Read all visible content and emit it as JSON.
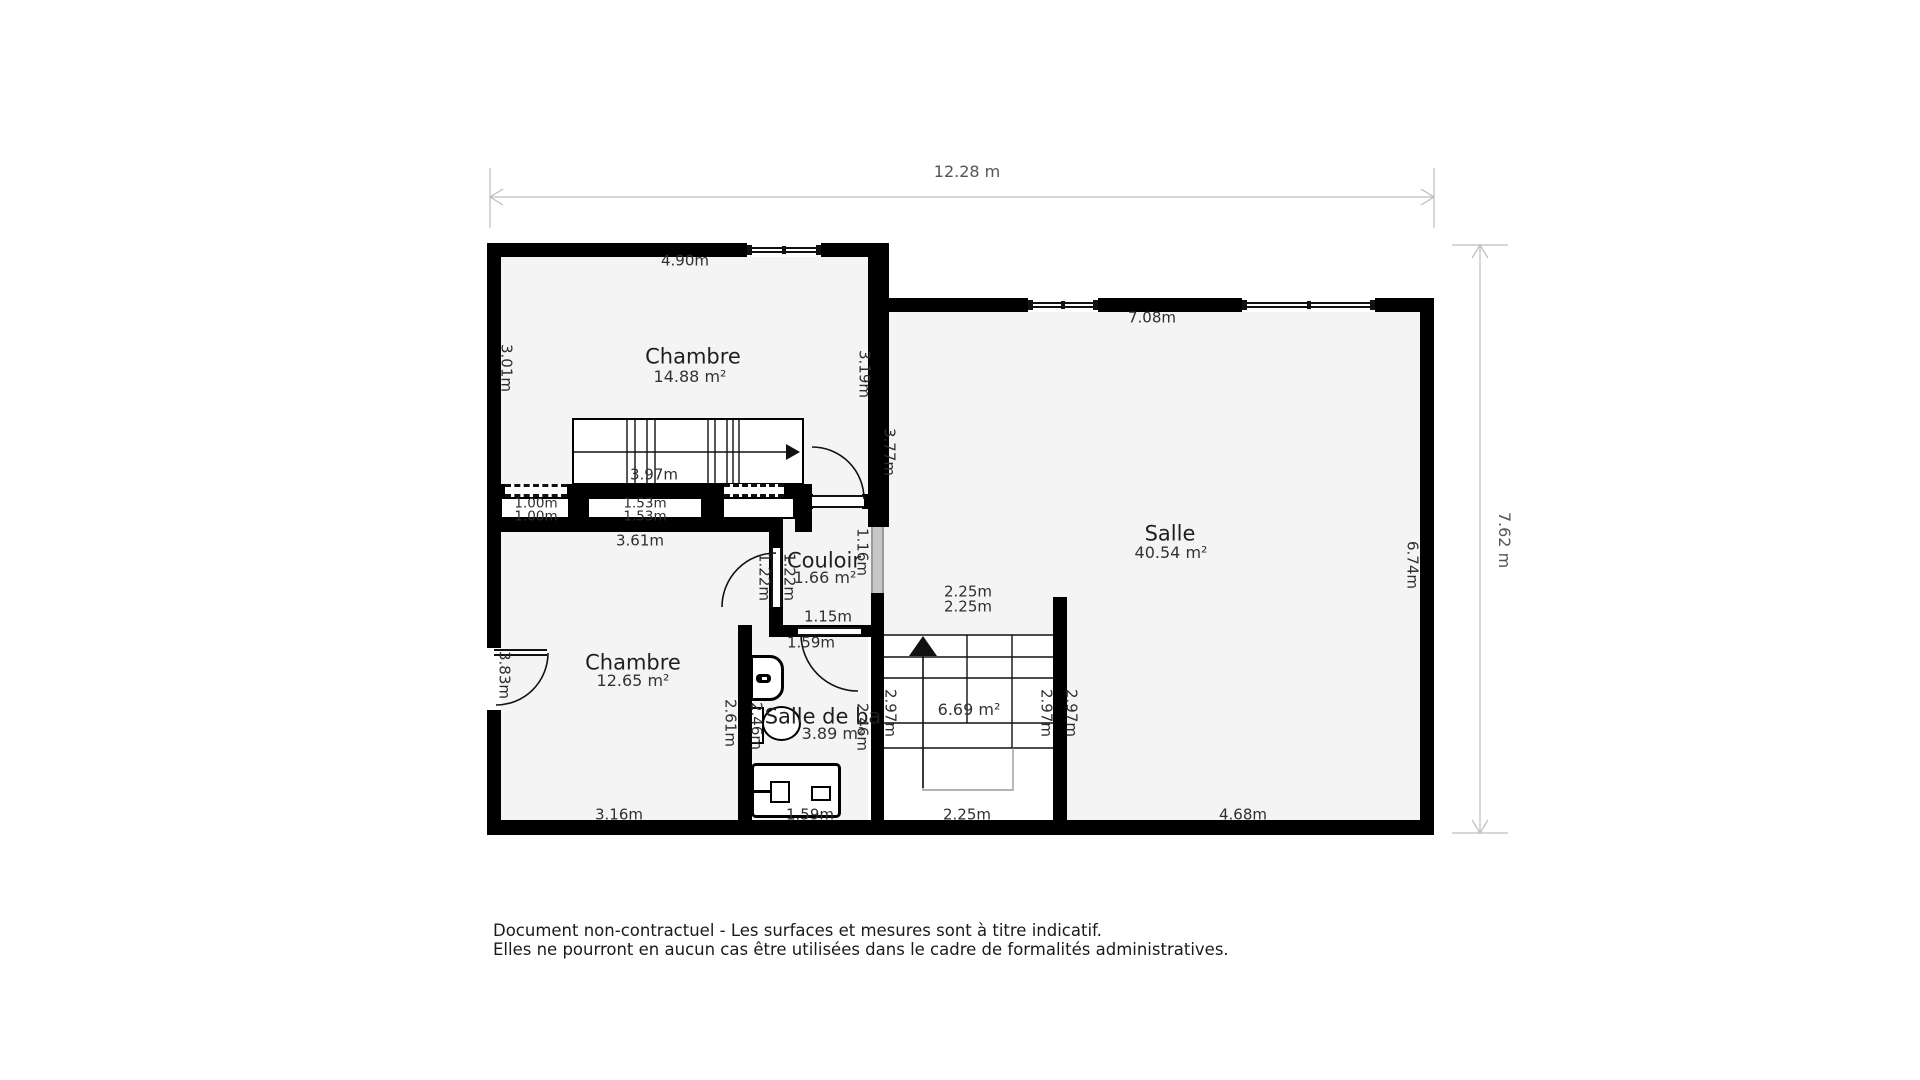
{
  "overall_dimensions": {
    "width": "12.28 m",
    "height": "7.62 m"
  },
  "rooms": {
    "chambre1": {
      "name": "Chambre",
      "area": "14.88 m²"
    },
    "salle": {
      "name": "Salle",
      "area": "40.54 m²"
    },
    "chambre2": {
      "name": "Chambre",
      "area": "12.65 m²"
    },
    "couloir": {
      "name": "Couloir",
      "area": "1.66 m²"
    },
    "salle_de_bain": {
      "name": "Salle de ba",
      "area": "3.89 m²"
    },
    "stairwell": {
      "area": "6.69 m²"
    }
  },
  "dims": {
    "chambre1_top": "4.90m",
    "chambre1_left": "3.01m",
    "chambre1_right": "3.19m",
    "stairs_upper": "3.97m",
    "closet_a_1": "1.00m",
    "closet_a_2": "1.00m",
    "closet_b_1": "1.53m",
    "closet_b_2": "1.53m",
    "chambre2_top": "3.61m",
    "chambre2_left_door": "3.83m",
    "chambre2_bottom": "3.16m",
    "salle_top": "7.08m",
    "salle_left": "3.77m",
    "salle_right": "6.74m",
    "salle_bottom": "4.68m",
    "couloir_left_inner": "1.22m",
    "couloir_left_outer": "1.22m",
    "couloir_right": "1.16m",
    "couloir_bottom": "1.15m",
    "bain_door": "1.59m",
    "bain_left_outer": "2.61m",
    "bain_left_inner": "2.46m",
    "bain_right": "2.46m",
    "bain_bottom": "1.59m",
    "stairwell_top_1": "2.25m",
    "stairwell_top_2": "2.25m",
    "stairwell_left": "2.97m",
    "stairwell_right_inner": "2.97m",
    "stairwell_right_outer": "2.97m",
    "stairwell_bottom": "2.25m"
  },
  "disclaimer": {
    "line1": "Document non-contractuel - Les surfaces et mesures sont à titre indicatif.",
    "line2": "Elles ne pourront en aucun cas être utilisées dans le cadre de formalités administratives."
  },
  "colors": {
    "wall": "#000000",
    "floor": "#f4f4f4",
    "dim_line": "#b8b8b8",
    "text": "#2e2e2e"
  }
}
